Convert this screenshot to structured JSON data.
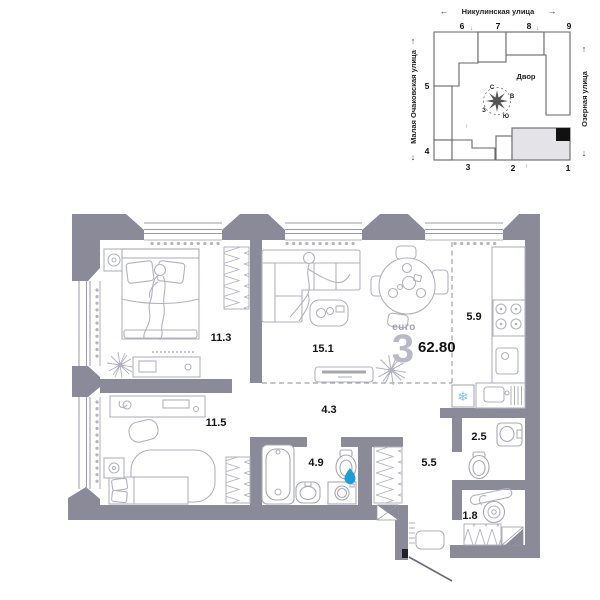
{
  "site_plan": {
    "street_top": "Никулинская улица",
    "street_left": "Малая Очаковская улица",
    "street_right": "Озерная улица",
    "courtyard_label": "Двор",
    "compass": {
      "north": "С",
      "east": "В",
      "south": "Ю",
      "west": "З"
    },
    "building_numbers": {
      "b1": "1",
      "b2": "2",
      "b3": "3",
      "b4": "4",
      "b5": "5",
      "b6": "6",
      "b7": "7",
      "b8": "8",
      "b9": "9"
    }
  },
  "apartment": {
    "type_label": "euro",
    "rooms_count": "3",
    "total_area": "62.80"
  },
  "rooms": {
    "bedroom_1": {
      "area": "11.3"
    },
    "living_room": {
      "area": "15.1"
    },
    "kitchen": {
      "area": "5.9"
    },
    "bedroom_2": {
      "area": "11.5"
    },
    "hallway": {
      "area": "4.3"
    },
    "bathroom": {
      "area": "4.9"
    },
    "corridor": {
      "area": "5.5"
    },
    "wc": {
      "area": "2.5"
    },
    "storage": {
      "area": "1.8"
    }
  },
  "icons": {
    "arrow_left": "←",
    "arrow_right": "→",
    "arrow_up": "↑",
    "arrow_down": "↓",
    "snowflake": "❄"
  },
  "colors": {
    "wall": "#8a8a99",
    "furniture": "#b2b2be",
    "accent_blue": "#1e9cd7",
    "light_blue": "#7cc3e8",
    "highlight_building": "#e4e4e8",
    "text": "#141414",
    "muted": "#a2a2ae"
  }
}
